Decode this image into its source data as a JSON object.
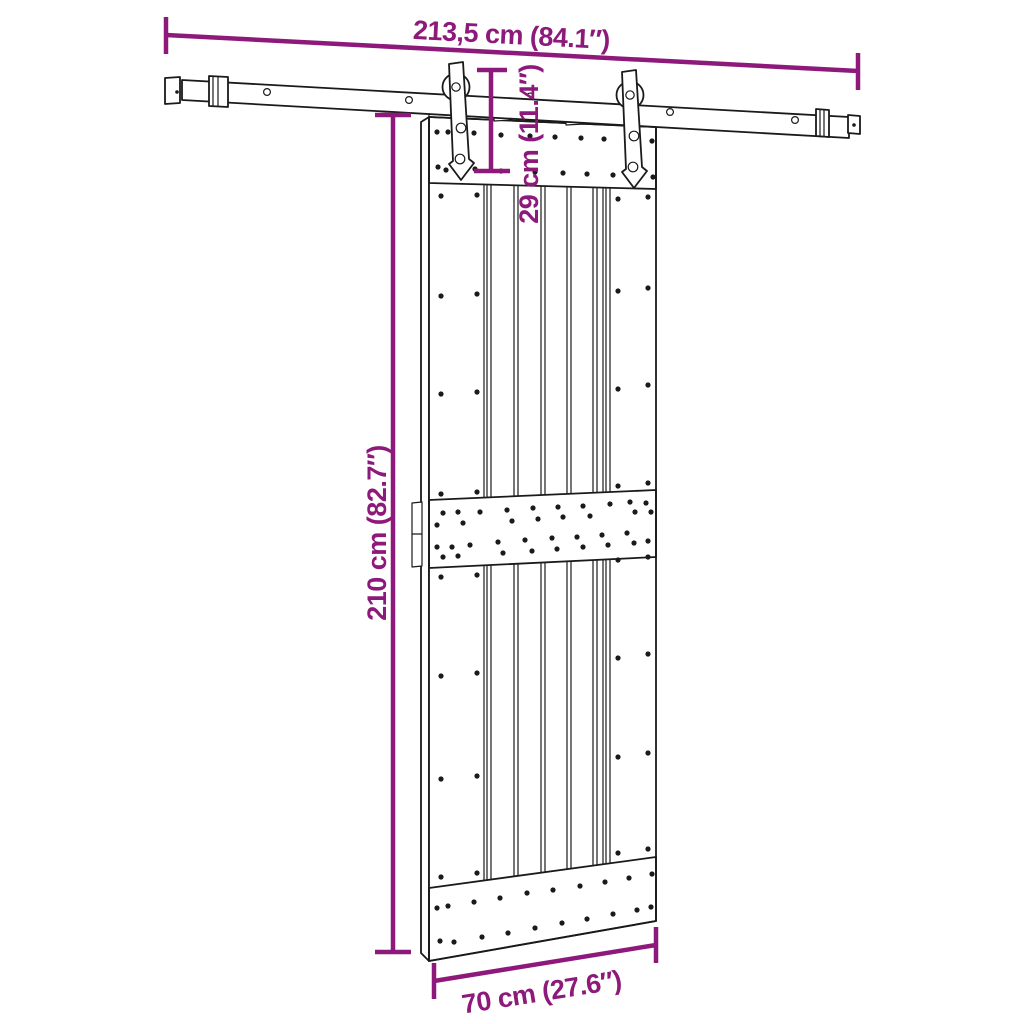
{
  "diagram": {
    "dimensions": {
      "rail_width_label": "213,5 cm (84.1″)",
      "hanger_height_label": "29 cm (11.4″)",
      "door_height_label": "210 cm (82.7″)",
      "door_width_label": "70 cm (27.6″)"
    },
    "colors": {
      "accent": "#8D1A7B",
      "line": "#1A1A1A",
      "background": "#FFFFFF"
    }
  }
}
